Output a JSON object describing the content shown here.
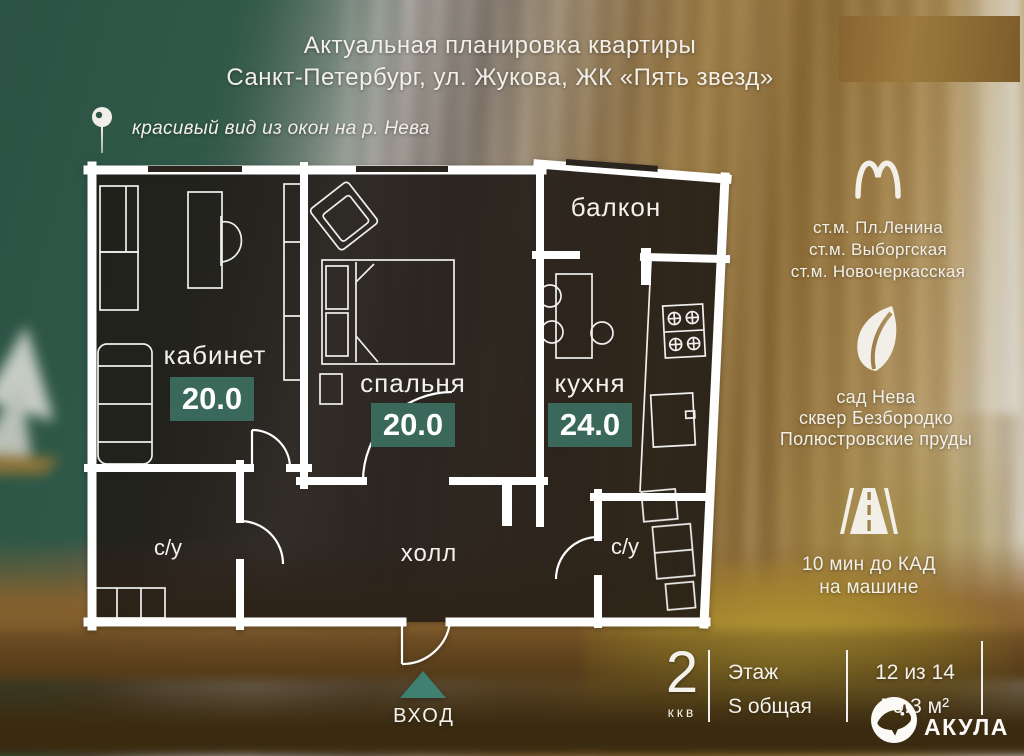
{
  "title": {
    "line1": "Актуальная  планировка квартиры",
    "line2": "Санкт-Петербург, ул. Жукова, ЖК «Пять звезд»"
  },
  "view_note": "красивый вид из окон на р. Нева",
  "plan": {
    "rooms": {
      "office": {
        "label": "кабинет",
        "area": "20.0"
      },
      "bedroom": {
        "label": "спальня",
        "area": "20.0"
      },
      "kitchen": {
        "label": "кухня",
        "area": "24.0"
      },
      "balcony": {
        "label": "балкон"
      },
      "hall": {
        "label": "холл"
      },
      "bath_left": {
        "label": "с/у"
      },
      "bath_right": {
        "label": "с/у"
      }
    },
    "entrance": {
      "label": "ВХОД"
    }
  },
  "info": {
    "metro": [
      "ст.м. Пл.Ленина",
      "ст.м. Выборгская",
      "ст.м. Новочеркасская"
    ],
    "parks": [
      "сад Нева",
      "сквер Безбородко",
      "Полюстровские пруды"
    ],
    "drive": [
      "10 мин до КАД",
      "на машине"
    ]
  },
  "summary": {
    "rooms_value": "2",
    "rooms_caption": "ккв",
    "floor_label": "Этаж",
    "area_label": "S общая",
    "floor_value": "12 из 14",
    "area_value": "79.3 м²"
  },
  "brand": "АКУЛА",
  "colors": {
    "badge": "#3a685a",
    "accent": "#3f8171",
    "wall": "#ffffff"
  }
}
